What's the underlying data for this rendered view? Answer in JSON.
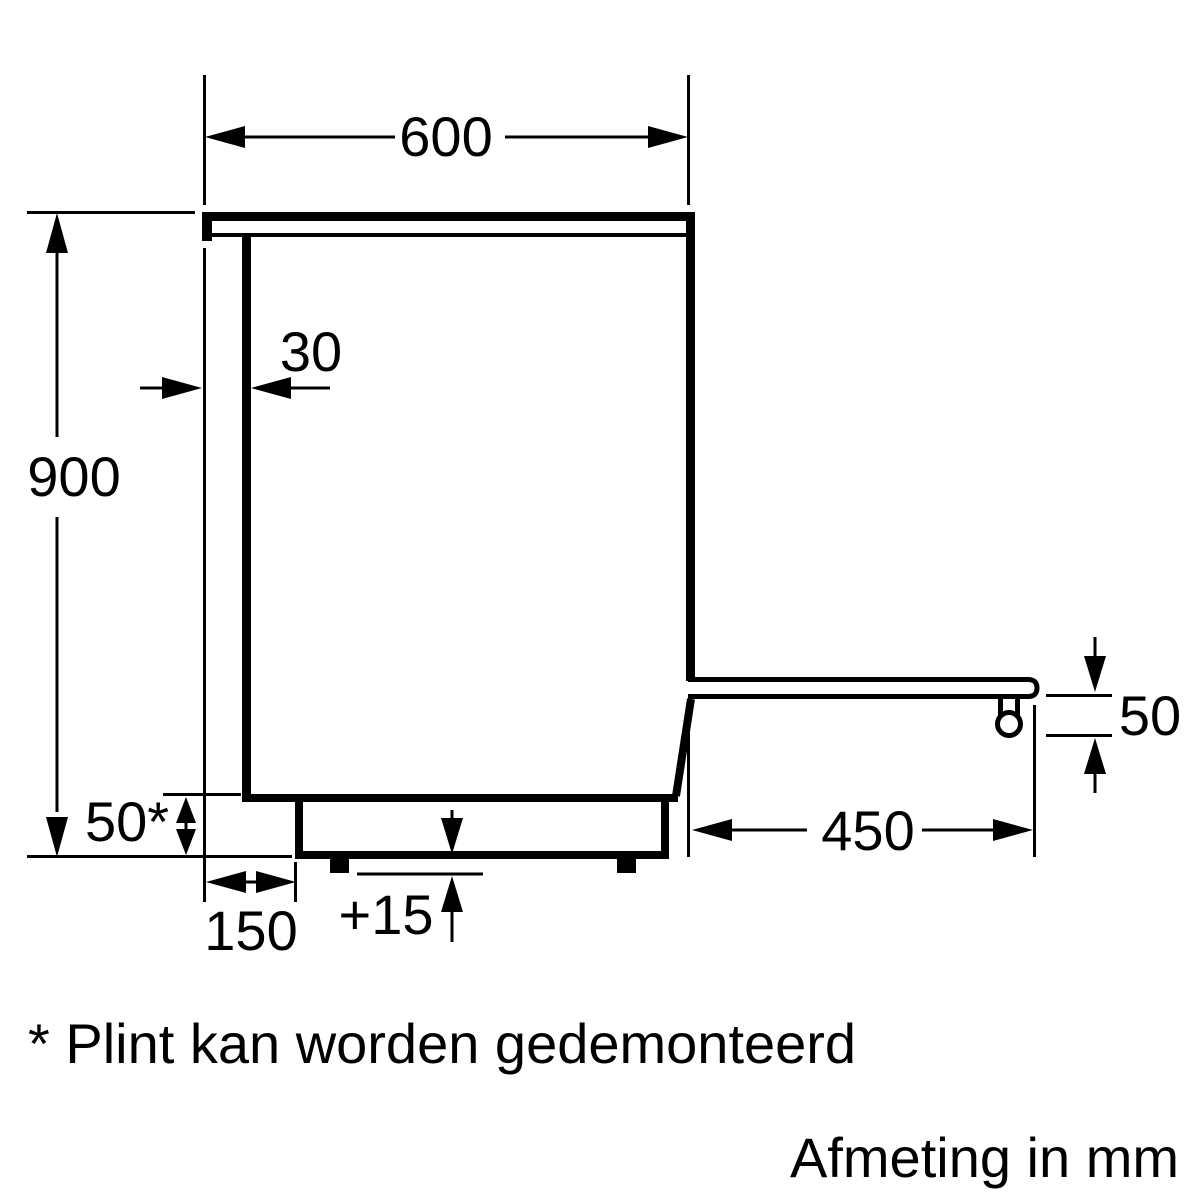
{
  "colors": {
    "background": "#ffffff",
    "line": "#000000",
    "text": "#000000"
  },
  "diagram": {
    "labels": {
      "top_width": "600",
      "overall_height": "900",
      "worktop_overhang": "30",
      "plinth_height": "50*",
      "plinth_recess_depth": "150",
      "height_adjustment": "+15",
      "open_door_depth": "450",
      "handle_clearance": "50"
    },
    "footnote": "* Plint kan worden gedemonteerd",
    "units_note": "Afmeting in mm"
  }
}
